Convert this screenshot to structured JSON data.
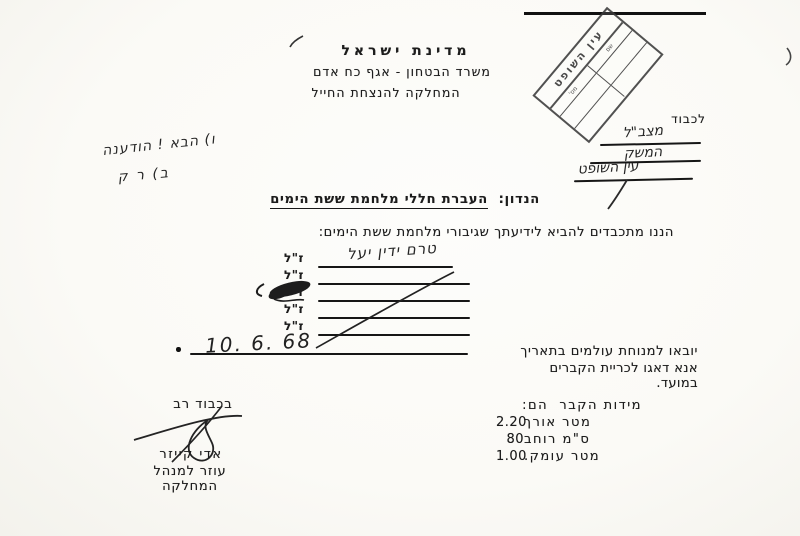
{
  "colors": {
    "paper": "#fbfaf6",
    "ink": "#1c1c1c",
    "stamp_ink": "#3a3a3a"
  },
  "header": {
    "line1": "מדינת  ישראל",
    "line2": "משרד הבטחון - אגף כח אדם",
    "line3": "המחלקה להנצחת החייל"
  },
  "stamp": {
    "title": "עין השופט",
    "cell_a": "שם",
    "cell_b": "מס'"
  },
  "recipient": {
    "label": "לכבוד",
    "hand_line1": "מצב\"ל",
    "hand_line2": "המשק",
    "hand_line3": "עין השופט"
  },
  "margin_notes": {
    "line1": "ו) הבא ! הודענה",
    "line2": "ב) ר ק"
  },
  "subject": {
    "label": "הנדון:",
    "text": "העברת חללי מלחמת ששת הימים"
  },
  "body": {
    "intro": "הננו מתכבדים להביא לידיעתך שגיבורי מלחמת ששת הימים:",
    "zal": "ז\"ל",
    "handwritten_name": "טרם ידין יעל",
    "date_sentence": "יובאו למנוחת עולמים בתאריך",
    "date_value": "10. 6. 68",
    "followup": "אנא דאגו לכריית הקברים במועד."
  },
  "dimensions": {
    "title": "מידות הקבר  הם:",
    "rows": [
      {
        "value": "2.20",
        "unit": "מטר אורך"
      },
      {
        "value": "80",
        "unit": "ס\"מ רוחב"
      },
      {
        "value": "1.00",
        "unit": "מטר עומק."
      }
    ]
  },
  "signature": {
    "closing": "בכבוד רב",
    "name": "אדי קייזר",
    "title": "עוזר למנהל המחלקה"
  }
}
